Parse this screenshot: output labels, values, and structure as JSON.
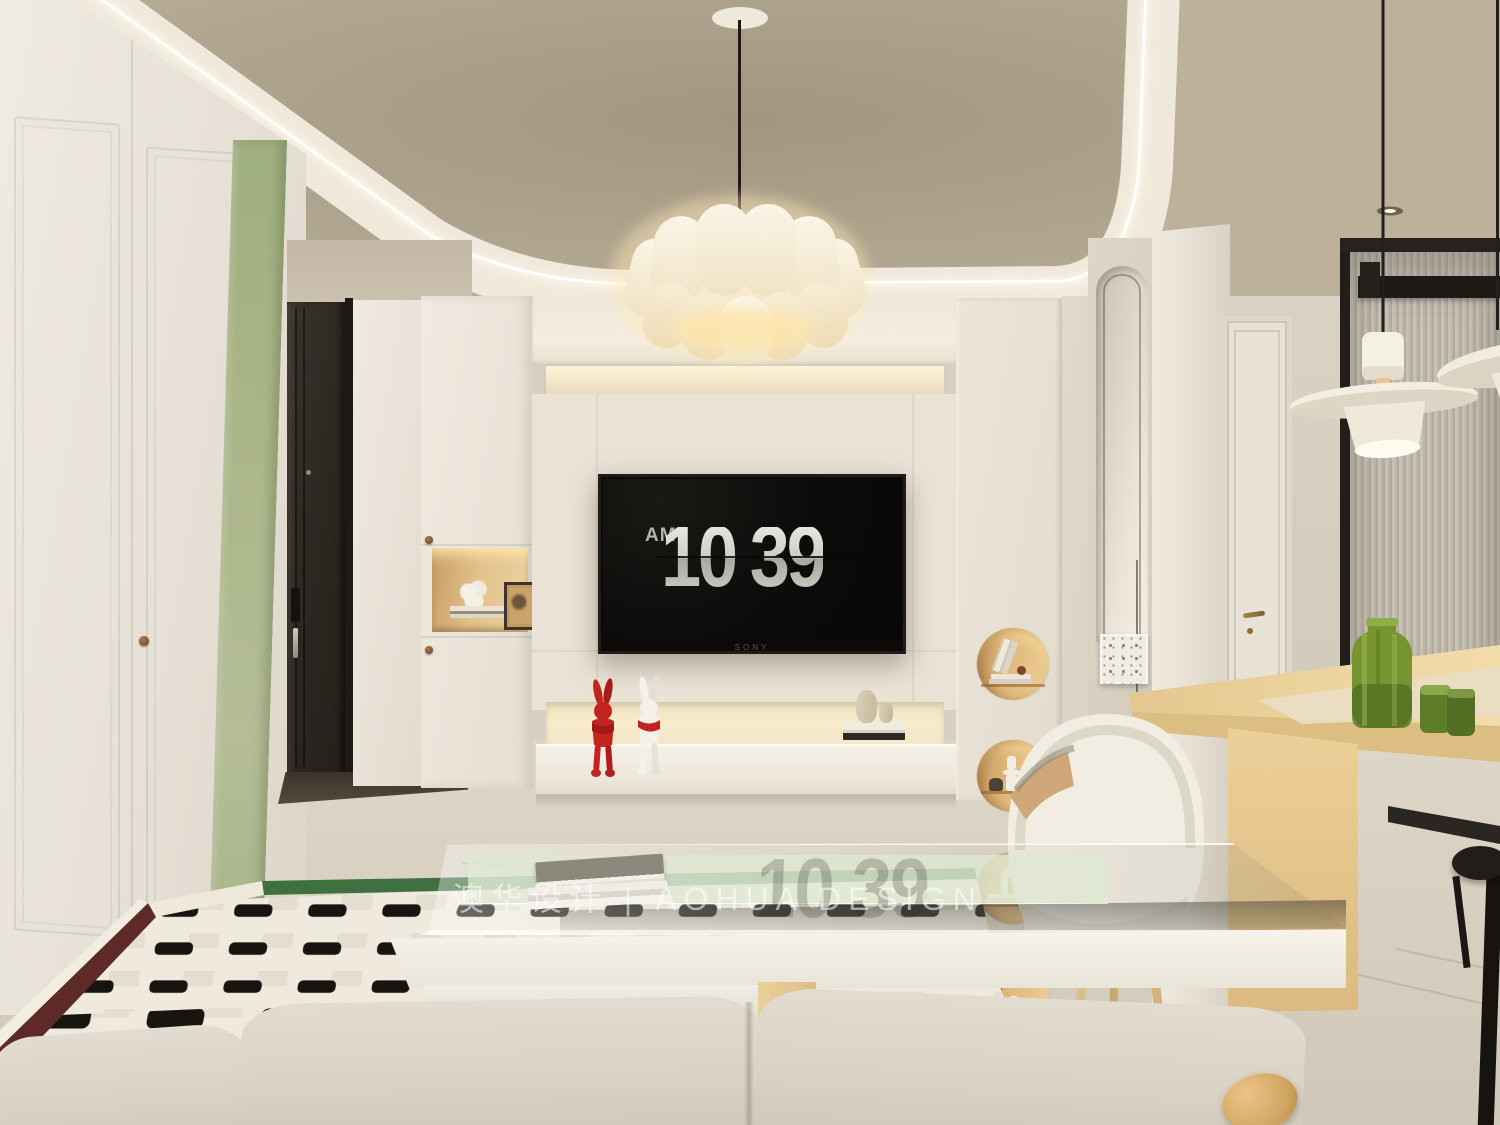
{
  "scene": {
    "description": "Cream modern living-dining room interior render",
    "watermark": "澳华设计 | AOHUA DESIGN",
    "tv": {
      "brand": "SONY",
      "clock_meridiem": "AM",
      "clock_hours": "10",
      "clock_minutes": "39",
      "reflection": "10 39"
    },
    "palette": {
      "ceiling_tan": "#b3a894",
      "cove_cream": "#efe8db",
      "led_white": "#fffdf5",
      "wall_cream": "#e9e2d5",
      "wall_shadow": "#d9d2c5",
      "accent_green": "#a9b489",
      "door_dark": "#2e2822",
      "niche_wood": "#d9ad6f",
      "warm_glow": "#fbe9c8",
      "table_wood": "#ead09c",
      "rug_ivory": "#efeadd",
      "rug_black": "#17150f",
      "rug_maroon": "#5d2a28",
      "rug_green": "#3f7040",
      "vase_green": "#6d8f33",
      "tv_black": "#0b0a08",
      "clock_silver": "#d5d4ce"
    }
  }
}
